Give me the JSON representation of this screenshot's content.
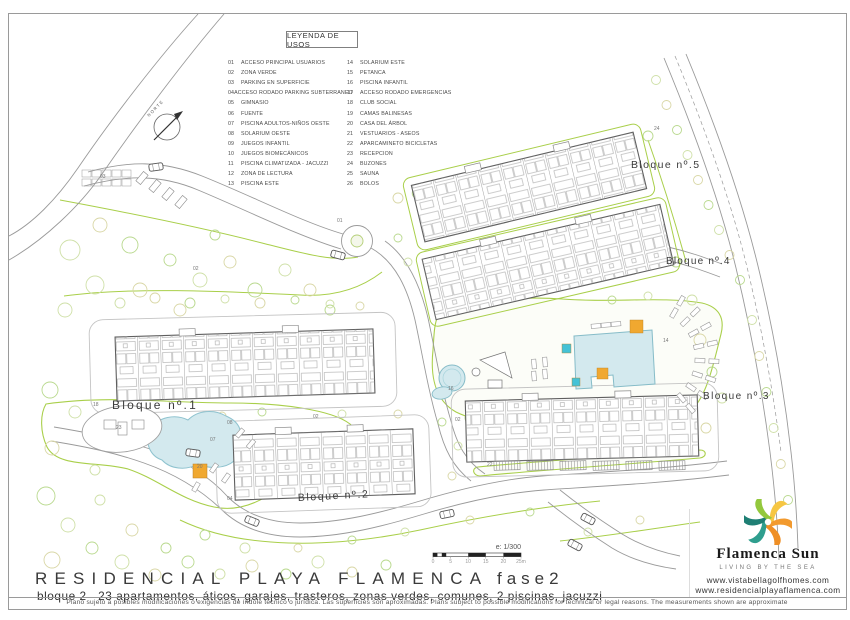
{
  "legend": {
    "title": "LEYENDA DE USOS",
    "left": [
      [
        "01",
        "ACCESO PRINCIPAL USUARIOS"
      ],
      [
        "02",
        "ZONA VERDE"
      ],
      [
        "03",
        "PARKING EN SUPERFICIE"
      ],
      [
        "04",
        "ACCESO RODADO PARKING SUBTERRANEO"
      ],
      [
        "05",
        "GIMNASIO"
      ],
      [
        "06",
        "FUENTE"
      ],
      [
        "07",
        "PISCINA ADULTOS-NIÑOS OESTE"
      ],
      [
        "08",
        "SOLARIUM OESTE"
      ],
      [
        "09",
        "JUEGOS INFANTIL"
      ],
      [
        "10",
        "JUEGOS BIOMECÁNICOS"
      ],
      [
        "11",
        "PISCINA CLIMATIZADA - JACUZZI"
      ],
      [
        "12",
        "ZONA DE LECTURA"
      ],
      [
        "13",
        "PISCINA ESTE"
      ]
    ],
    "right": [
      [
        "14",
        "SOLARIUM ESTE"
      ],
      [
        "15",
        "PETANCA"
      ],
      [
        "16",
        "PISCINA INFANTIL"
      ],
      [
        "17",
        "ACCESO RODADO EMERGENCIAS"
      ],
      [
        "18",
        "CLUB SOCIAL"
      ],
      [
        "19",
        "CAMAS BALINESAS"
      ],
      [
        "20",
        "CASA DEL ÁRBOL"
      ],
      [
        "21",
        "VESTUARIOS - ASEOS"
      ],
      [
        "22",
        "APARCAMINETO BICICLETAS"
      ],
      [
        "23",
        "RECEPCION"
      ],
      [
        "24",
        "BUZONES"
      ],
      [
        "25",
        "SAUNA"
      ],
      [
        "26",
        "BOLOS"
      ]
    ]
  },
  "plan": {
    "north_label": "NORTE",
    "blocks": [
      {
        "label": "Bloque nº.1",
        "x": 112,
        "y": 409,
        "size": 12,
        "ls": 2.2,
        "rot": 0
      },
      {
        "label": "Bloque nº.2",
        "x": 298,
        "y": 501,
        "size": 10.5,
        "ls": 1.6,
        "rot": -3
      },
      {
        "label": "Bloque nº.3",
        "x": 703,
        "y": 399,
        "size": 10,
        "ls": 1.4,
        "rot": 0
      },
      {
        "label": "Bloque nº.4",
        "x": 666,
        "y": 264,
        "size": 10,
        "ls": 1.2,
        "rot": 0
      },
      {
        "label": "Bloque nº.5",
        "x": 631,
        "y": 168,
        "size": 10.5,
        "ls": 1.4,
        "rot": 0
      }
    ],
    "markers": [
      {
        "n": "03",
        "x": 100,
        "y": 178
      },
      {
        "n": "01",
        "x": 337,
        "y": 222
      },
      {
        "n": "02",
        "x": 193,
        "y": 270
      },
      {
        "n": "02",
        "x": 313,
        "y": 418
      },
      {
        "n": "02",
        "x": 455,
        "y": 421
      },
      {
        "n": "08",
        "x": 227,
        "y": 424
      },
      {
        "n": "07",
        "x": 210,
        "y": 441
      },
      {
        "n": "18",
        "x": 93,
        "y": 406
      },
      {
        "n": "23",
        "x": 116,
        "y": 429
      },
      {
        "n": "20",
        "x": 197,
        "y": 468
      },
      {
        "n": "04",
        "x": 227,
        "y": 500
      },
      {
        "n": "16",
        "x": 448,
        "y": 390
      },
      {
        "n": "22",
        "x": 487,
        "y": 466
      },
      {
        "n": "14",
        "x": 663,
        "y": 342
      },
      {
        "n": "24",
        "x": 654,
        "y": 130
      }
    ]
  },
  "scale": {
    "label": "e: 1/300",
    "ticks": [
      "0",
      "5",
      "10",
      "15",
      "20",
      "25m"
    ]
  },
  "title_block": {
    "project": "RESIDENCIAL PLAYA FLAMENCA",
    "phase": "fase2",
    "details": "bloque 2   23 apartamentos, áticos, garajes, trasteros, zonas verdes, comunes, 2 piscinas, jacuzzi"
  },
  "brand": {
    "name": "Flamenca Sun",
    "tagline": "LIVING BY THE SEA",
    "url1": "www.vistabellagolfhomes.com",
    "url2": "www.residencialplayaflamenca.com",
    "petal_colors": [
      "#f6c643",
      "#f29a2e",
      "#ef8f25",
      "#2f9e8e",
      "#1f7f74",
      "#93c83d"
    ]
  },
  "disclaimer": "Plano sujeto a posibles modificaciones o exigencias de índole técnico o jurídica. Las superficies son aproximadas. Plans subject to possible modifications for technical or legal reasons. The measurements shown are approximate",
  "colors": {
    "green_line": "#a9cf4a",
    "pool_fill": "#d3e9ee",
    "pool_edge": "#86bcc8",
    "cyan": "#45c2d6",
    "orange": "#f0a830",
    "tree_tan": "#d9d7a6",
    "tree_green": "#b9d98e",
    "tree_pale": "#cfe0a8",
    "road": "#9a9a9a",
    "building_edge": "#5f5f5f",
    "parcel": "#c4c4c4"
  }
}
